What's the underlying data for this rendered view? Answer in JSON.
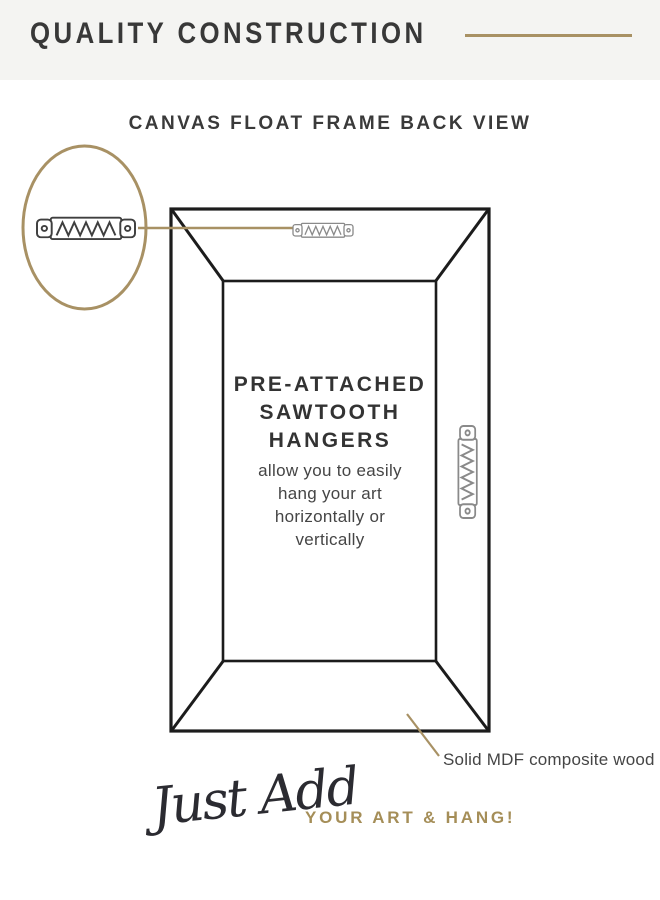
{
  "header": {
    "title": "QUALITY CONSTRUCTION"
  },
  "diagram": {
    "title": "CANVAS FLOAT FRAME BACK VIEW",
    "heading": [
      "PRE-ATTACHED",
      "SAWTOOTH",
      "HANGERS"
    ],
    "body": [
      "allow you to easily",
      "hang your art",
      "horizontally or",
      "vertically"
    ],
    "material_callout": "Solid MDF composite wood",
    "icons": [
      "magnifier-circle",
      "sawtooth-hanger-zoom-icon",
      "sawtooth-hanger-top-icon",
      "sawtooth-hanger-side-icon"
    ]
  },
  "footer": {
    "script_text": "Just Add",
    "cta_text": "YOUR ART & HANG!"
  },
  "colors": {
    "accent_gold": "#a89164",
    "line_black": "#1c1c1c",
    "hanger_gray": "#8a8a8a",
    "hanger_dark": "#3f3f3f",
    "header_bg": "#f4f4f2",
    "text_dark": "#383838",
    "text_body": "#454545",
    "cta_gold": "#a58e58"
  }
}
